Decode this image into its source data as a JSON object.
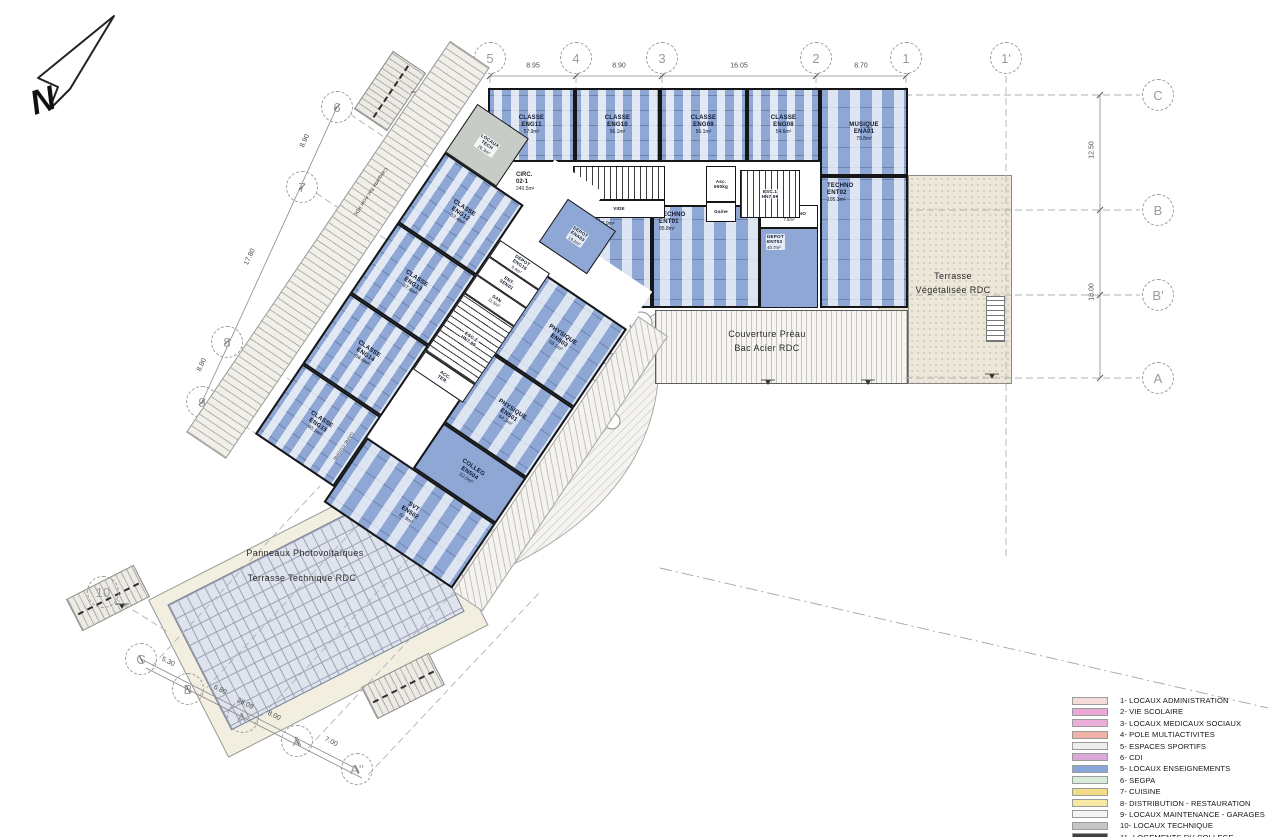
{
  "annotations": {
    "north": "N",
    "preau1": "Couverture Préau",
    "preau2": "Bac Acier RDC",
    "terrasse1": "Terrasse",
    "terrasse2": "Végétalisée RDC",
    "pv1": "Panneaux Photovoltaïques",
    "pv2": "Terrasse Technique RDC",
    "casquette": "Casquette Bac Acier RDC",
    "gaine_cuisine": "GAINE CUISINE"
  },
  "rooms": {
    "locaux_tech": {
      "l1": "LOCAUX",
      "l2": "TECH",
      "area": "26.3m²"
    },
    "eng11": {
      "l1": "CLASSE",
      "l2": "ENG11",
      "area": "57.9m²"
    },
    "eng10": {
      "l1": "CLASSE",
      "l2": "ENG10",
      "area": "56.1m²"
    },
    "eng09": {
      "l1": "CLASSE",
      "l2": "ENG09",
      "area": "56.1m²"
    },
    "eng08": {
      "l1": "CLASSE",
      "l2": "ENG08",
      "area": "54.6m²"
    },
    "musique": {
      "l1": "MUSIQUE",
      "l2": "ENA01",
      "area": "79.8m²"
    },
    "plastik": {
      "l1": "PLASTIK",
      "l2": "ENA02",
      "area": "79.9m²"
    },
    "depot_ena03": {
      "l1": "DEPOT",
      "l2": "ENA03",
      "area": "19.2m²"
    },
    "techno1": {
      "l1": "TECHNO",
      "l2": "ENT01",
      "area": "95.8m²"
    },
    "circ_techno": {
      "l1": "CIRC.TECHNO",
      "area": "7.6m²"
    },
    "depot_ent03": {
      "l1": "DEPOT",
      "l2": "ENT03",
      "area": "40.7m²"
    },
    "techno2": {
      "l1": "TECHNO",
      "l2": "ENT02",
      "area": "105.3m²"
    },
    "eng12": {
      "l1": "CLASSE",
      "l2": "ENG12",
      "area": "57.4m²"
    },
    "eng13": {
      "l1": "CLASSE",
      "l2": "ENG13",
      "area": "57.4m²"
    },
    "eng14": {
      "l1": "CLASSE",
      "l2": "ENG14",
      "area": "56.6m²"
    },
    "eng15": {
      "l1": "CLASSE",
      "l2": "ENG15",
      "area": "60.1m²"
    },
    "depot_eng16": {
      "l1": "DEPOT",
      "l2": "ENG16",
      "area": "9.4m²"
    },
    "ent_sen01": {
      "l1": "ENT.",
      "l2": "SEN01"
    },
    "san": {
      "l1": "SAN",
      "area": "11.5m²"
    },
    "esc2": {
      "l1": "ESC.2",
      "l2": "HN7.99"
    },
    "acc_ter": {
      "l1": "ACC.",
      "l2": "TER."
    },
    "phys503": {
      "l1": "PHYSIQUE",
      "l2": "EN503",
      "area": "58.1m²"
    },
    "phys501": {
      "l1": "PHYSIQUE",
      "l2": "EN501",
      "area": "64.3m²"
    },
    "colleg504": {
      "l1": "COLLEG",
      "l2": "EN504",
      "area": "52.0m²"
    },
    "svt502": {
      "l1": "SVT",
      "l2": "EN502",
      "area": "62.9m²"
    },
    "esc1": {
      "l1": "ESC.1",
      "l2": "HN7.99"
    },
    "asc": {
      "l1": "Asc.",
      "l2": "600kg"
    },
    "gaine": {
      "l1": "Gaine"
    },
    "vide": {
      "l1": "VIDE"
    },
    "circ021": {
      "l1": "CIRC.",
      "l2": "02-1",
      "area": "240.5m²"
    }
  },
  "grid": {
    "axis_labels": [
      "5",
      "4",
      "3",
      "2",
      "1",
      "1'",
      "C",
      "B",
      "B'",
      "A",
      "6",
      "7",
      "8",
      "9",
      "10",
      "C",
      "B",
      "A'",
      "A",
      "A''"
    ],
    "dim_values": [
      "8.95",
      "8.90",
      "16.05",
      "8.70",
      "12.50",
      "18.00",
      "8.90",
      "17.80",
      "8.80",
      "5.30",
      "6.80",
      "8.00",
      "7.00",
      "26.09"
    ]
  },
  "legend": {
    "items": [
      {
        "num": "1-",
        "label": "LOCAUX ADMINISTRATION",
        "color": "#f6dbdb"
      },
      {
        "num": "2-",
        "label": "VIE SCOLAIRE",
        "color": "#eaa8d5"
      },
      {
        "num": "3-",
        "label": "LOCAUX MEDICAUX SOCIAUX",
        "color": "#e9afd8"
      },
      {
        "num": "4-",
        "label": "POLE MULTIACTIVITES",
        "color": "#f1b3a8"
      },
      {
        "num": "5-",
        "label": "ESPACES SPORTIFS",
        "color": "#ededec"
      },
      {
        "num": "6-",
        "label": "CDI",
        "color": "#dcaada"
      },
      {
        "num": "5-",
        "label": "LOCAUX ENSEIGNEMENTS",
        "color": "#88a6d7"
      },
      {
        "num": "6-",
        "label": "SEGPA",
        "color": "#d9ecdb"
      },
      {
        "num": "7-",
        "label": "CUISINE",
        "color": "#f2dc85"
      },
      {
        "num": "8-",
        "label": "DISTRIBUTION - RESTAURATION",
        "color": "#f7e8a3"
      },
      {
        "num": "9-",
        "label": "LOCAUX MAINTENANCE - GARAGES",
        "color": "#f4f4f3"
      },
      {
        "num": "10-",
        "label": "LOCAUX TECHNIQUE",
        "color": "#c6c6c5"
      },
      {
        "num": "11-",
        "label": "LOGEMENTS DU COLLEGE",
        "color": "#404040"
      }
    ]
  },
  "plan_colors": {
    "enseignement_blue": "#8ea7d4",
    "technique_gray": "#c8ccc7",
    "wall": "#161616"
  }
}
